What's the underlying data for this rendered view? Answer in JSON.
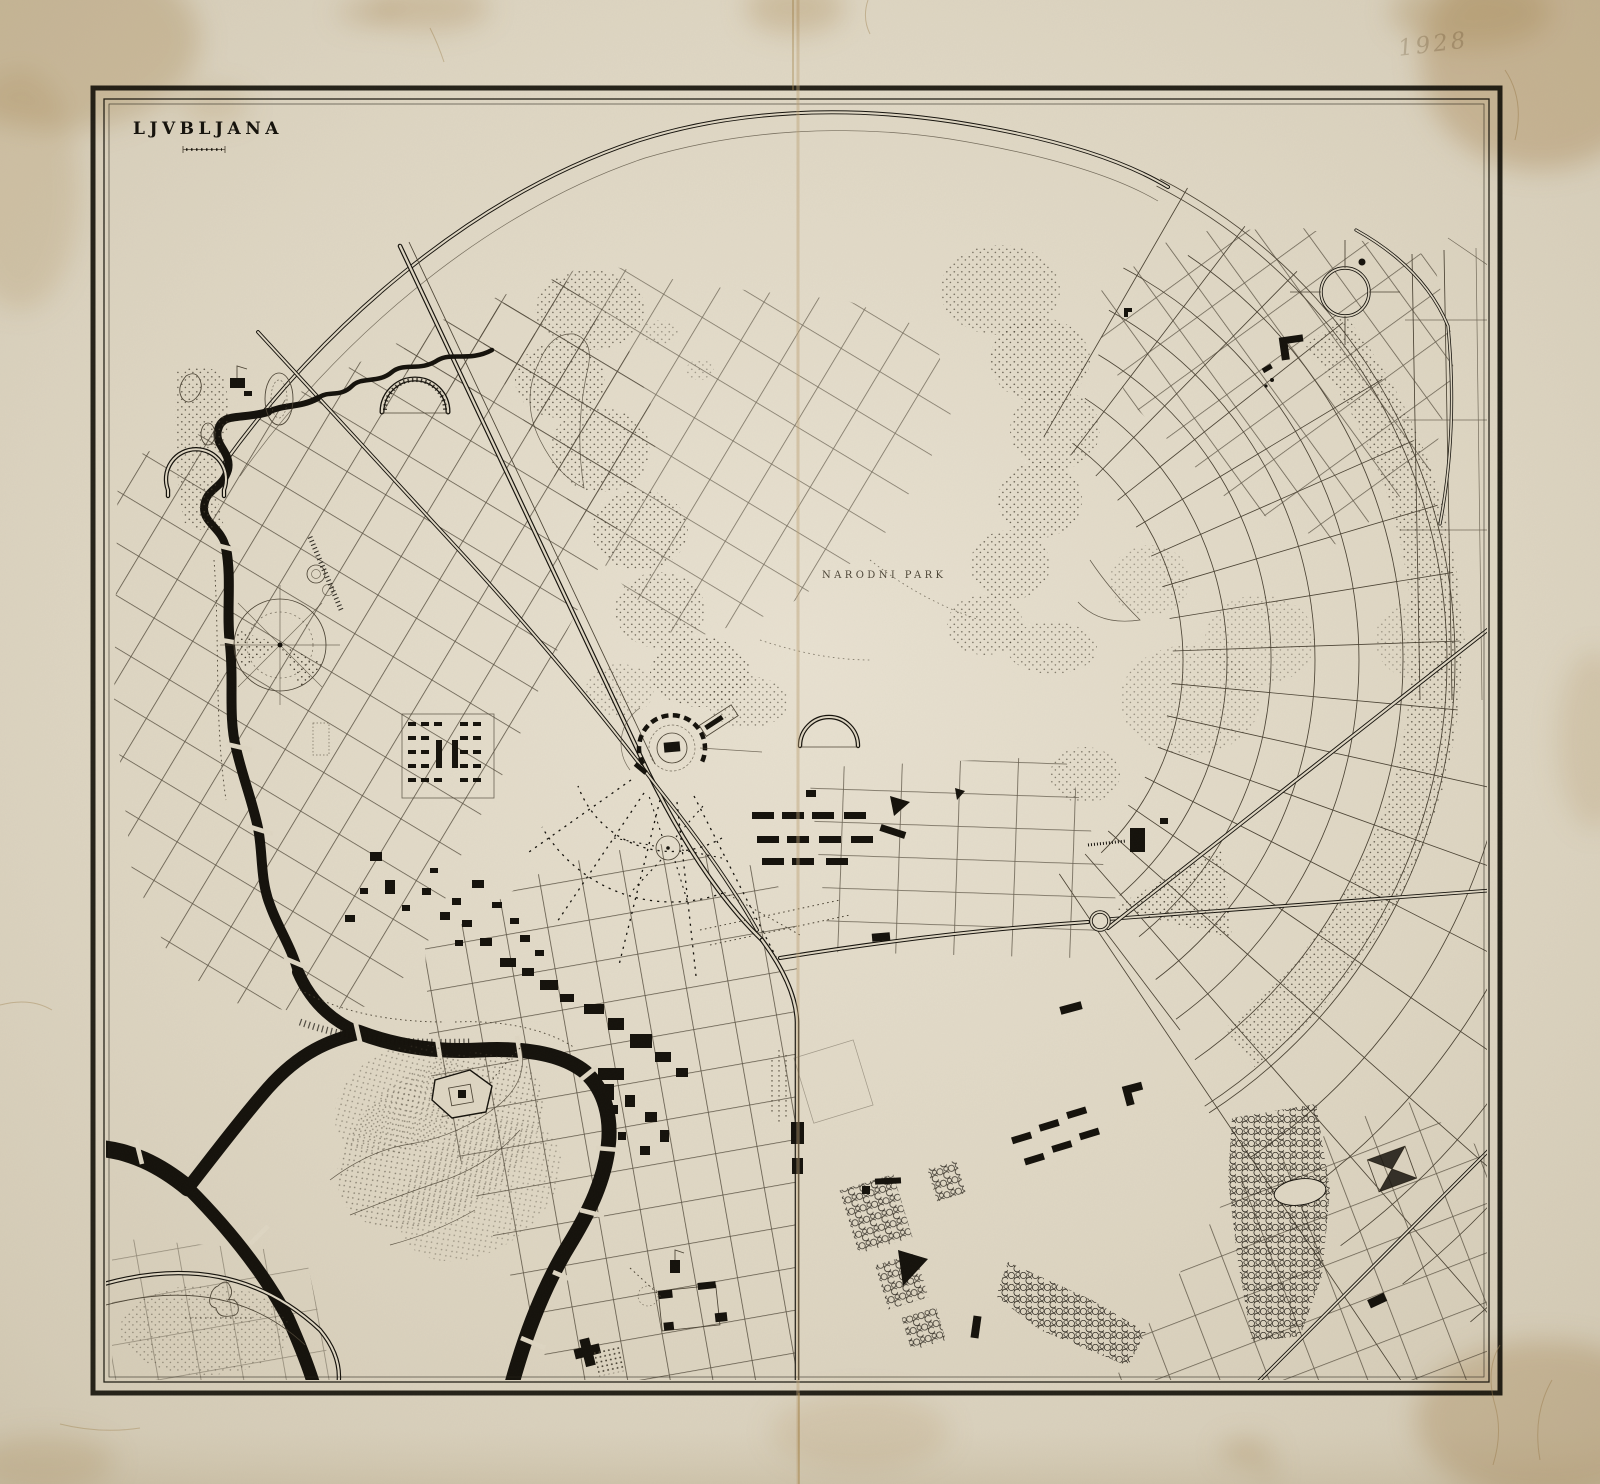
{
  "map": {
    "title": "LJVBLJANA",
    "labels": {
      "park": "NARODNI PARK"
    },
    "pencil_inscription": "1928"
  },
  "palette": {
    "paper": "#ded6c3",
    "paper_light": "#e8e1d1",
    "paper_dark": "#cdc3ac",
    "ink": "#16130d",
    "street": "#4c4435",
    "stipple": "#453e30",
    "frame": "#26231a",
    "stain": "#c19e66",
    "pencil": "#9b8c72"
  },
  "features": [
    "border-frame",
    "title",
    "scale-bar",
    "ring-boulevard",
    "railway-lines",
    "river-ljubljanica",
    "old-town-buildings",
    "castle-hill",
    "central-stadium",
    "circular-plaza",
    "radial-street-fan",
    "street-grids",
    "narodni-park",
    "tree-lined-blocks",
    "fold-crease",
    "foxing-stains",
    "pencil-inscription"
  ]
}
